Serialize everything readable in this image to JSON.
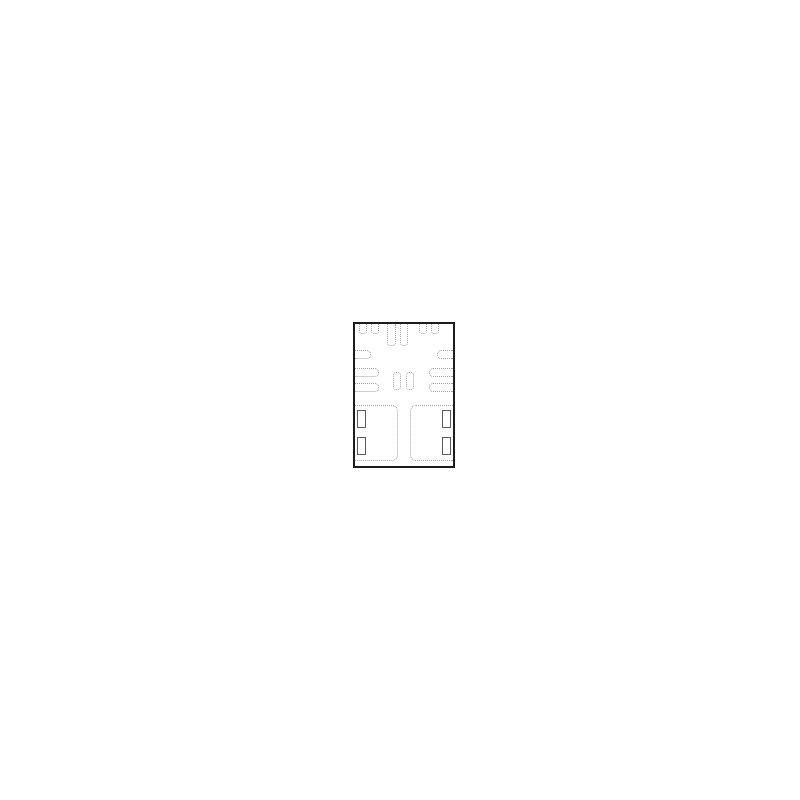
{
  "canvas": {
    "background": "#ffffff",
    "width": 800,
    "height": 800
  },
  "diagram": {
    "description": "ic-package-land-pattern-bottom-view",
    "package": {
      "x": 353,
      "y": 322,
      "width": 102,
      "height": 146,
      "border_color": "#1c1c1c",
      "border_width": 2,
      "fill": "#ffffff",
      "pad_outline_color": "#a0a0a0",
      "slot_outline_color": "#5a5a5a",
      "pads": [
        {
          "name": "top-pad-1",
          "x": 4,
          "y": 0,
          "w": 8,
          "h": 10,
          "style": "dotted",
          "open": "top",
          "r": [
            0,
            0,
            3,
            3
          ]
        },
        {
          "name": "top-pad-2",
          "x": 16,
          "y": 0,
          "w": 8,
          "h": 10,
          "style": "dotted",
          "open": "top",
          "r": [
            0,
            0,
            3,
            3
          ]
        },
        {
          "name": "top-pad-3-long",
          "x": 32,
          "y": 0,
          "w": 9,
          "h": 22,
          "style": "dotted",
          "open": "top",
          "r": [
            0,
            0,
            3,
            3
          ]
        },
        {
          "name": "top-pad-4-long",
          "x": 45,
          "y": 0,
          "w": 8,
          "h": 22,
          "style": "dotted",
          "open": "top",
          "r": [
            0,
            0,
            3,
            3
          ]
        },
        {
          "name": "top-pad-5",
          "x": 64,
          "y": 0,
          "w": 8,
          "h": 10,
          "style": "dotted",
          "open": "top",
          "r": [
            0,
            0,
            3,
            3
          ]
        },
        {
          "name": "top-pad-6",
          "x": 76,
          "y": 0,
          "w": 8,
          "h": 10,
          "style": "dotted",
          "open": "top",
          "r": [
            0,
            0,
            3,
            3
          ]
        },
        {
          "name": "left-corner-tab",
          "x": 0,
          "y": 26,
          "w": 16,
          "h": 9,
          "style": "dotted",
          "open": "left",
          "r": [
            0,
            4,
            4,
            0
          ]
        },
        {
          "name": "left-pad-1",
          "x": 0,
          "y": 44,
          "w": 24,
          "h": 9,
          "style": "dotted",
          "open": "left",
          "r": [
            0,
            4,
            4,
            0
          ]
        },
        {
          "name": "left-pad-2",
          "x": 0,
          "y": 59,
          "w": 24,
          "h": 9,
          "style": "dotted",
          "open": "left",
          "r": [
            0,
            4,
            4,
            0
          ]
        },
        {
          "name": "right-corner-tab",
          "x": 82,
          "y": 26,
          "w": 16,
          "h": 9,
          "style": "dotted",
          "open": "right",
          "r": [
            4,
            0,
            0,
            4
          ]
        },
        {
          "name": "right-pad-1",
          "x": 74,
          "y": 44,
          "w": 24,
          "h": 9,
          "style": "dotted",
          "open": "right",
          "r": [
            4,
            0,
            0,
            4
          ]
        },
        {
          "name": "right-pad-2",
          "x": 74,
          "y": 59,
          "w": 24,
          "h": 9,
          "style": "dotted",
          "open": "right",
          "r": [
            4,
            0,
            0,
            4
          ]
        },
        {
          "name": "center-pad-1",
          "x": 38,
          "y": 48,
          "w": 8,
          "h": 18,
          "style": "dotted",
          "open": "none",
          "r": [
            3,
            3,
            3,
            3
          ]
        },
        {
          "name": "center-pad-2",
          "x": 51,
          "y": 48,
          "w": 8,
          "h": 18,
          "style": "dotted",
          "open": "none",
          "r": [
            3,
            3,
            3,
            3
          ]
        },
        {
          "name": "bottom-left-thermal-pad",
          "x": 0,
          "y": 81,
          "w": 43,
          "h": 56,
          "style": "dotted",
          "open": "left",
          "r": [
            0,
            6,
            6,
            0
          ]
        },
        {
          "name": "bottom-right-thermal-pad",
          "x": 55,
          "y": 81,
          "w": 43,
          "h": 56,
          "style": "dotted",
          "open": "right",
          "r": [
            6,
            0,
            0,
            6
          ]
        },
        {
          "name": "bottom-left-slot-1",
          "x": 2,
          "y": 86,
          "w": 9,
          "h": 18,
          "style": "solid",
          "open": "none",
          "r": [
            0,
            0,
            0,
            0
          ]
        },
        {
          "name": "bottom-left-slot-2",
          "x": 2,
          "y": 113,
          "w": 9,
          "h": 18,
          "style": "solid",
          "open": "none",
          "r": [
            0,
            0,
            0,
            0
          ]
        },
        {
          "name": "bottom-right-slot-1",
          "x": 87,
          "y": 86,
          "w": 9,
          "h": 18,
          "style": "solid",
          "open": "none",
          "r": [
            0,
            0,
            0,
            0
          ]
        },
        {
          "name": "bottom-right-slot-2",
          "x": 87,
          "y": 113,
          "w": 9,
          "h": 18,
          "style": "solid",
          "open": "none",
          "r": [
            0,
            0,
            0,
            0
          ]
        }
      ]
    }
  }
}
